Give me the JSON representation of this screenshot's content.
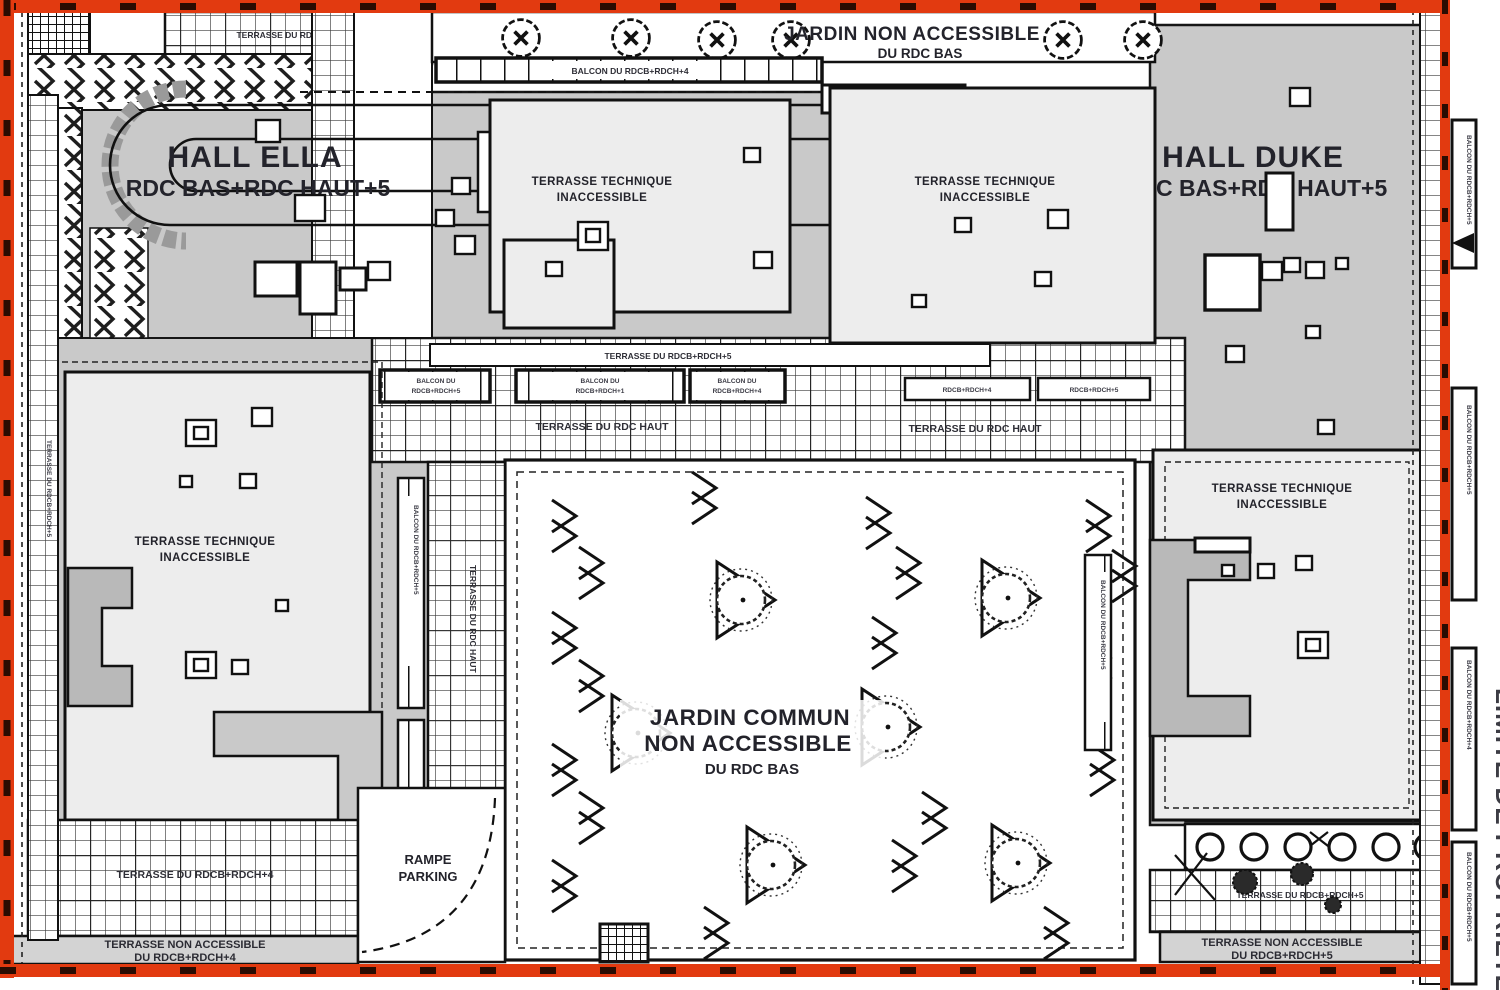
{
  "colors": {
    "roof_gray": "#c9c9c9",
    "panel_light": "#ededed",
    "band_gray": "#d3d3d3",
    "line_black": "#1b1b1b",
    "property_red": "#e23a10",
    "text_dark": "#23232b"
  },
  "halls": {
    "ella_name": "HALL ELLA",
    "ella_levels": "RDC BAS+RDC HAUT+5",
    "duke_name": "HALL DUKE",
    "duke_levels": "RDC BAS+RDC HAUT+5"
  },
  "garden_north": {
    "l1": "JARDIN NON ACCESSIBLE",
    "l2": "DU RDC BAS"
  },
  "garden_central": {
    "l1": "JARDIN COMMUN",
    "l2": "NON ACCESSIBLE",
    "l3": "DU RDC BAS"
  },
  "tech_terrace": {
    "l1": "TERRASSE TECHNIQUE",
    "l2": "INACCESSIBLE"
  },
  "ramp": {
    "l1": "RAMPE",
    "l2": "PARKING"
  },
  "labels": {
    "terr_rdcb5": "TERRASSE DU RDCB+RDCH+5",
    "terr_rdcb4": "TERRASSE DU RDCB+RDCH+4",
    "terr_rdc_haut": "TERRASSE DU RDC HAUT",
    "balcon_du": "BALCON DU",
    "rdcb5": "RDCB+RDCH+5",
    "rdcb4": "RDCB+RDCH+4",
    "rdcb1": "RDCB+RDCH+1",
    "balcon_rdcb4": "BALCON DU RDCB+RDCH+4",
    "balcon_rdcb5": "BALCON DU RDCB+RDCH+5",
    "non_acc": "TERRASSE NON ACCESSIBLE",
    "du_rdcb4": "DU RDCB+RDCH+4",
    "du_rdcb5": "DU RDCB+RDCH+5",
    "limite": "LIMITE DE PROPRIETE"
  }
}
